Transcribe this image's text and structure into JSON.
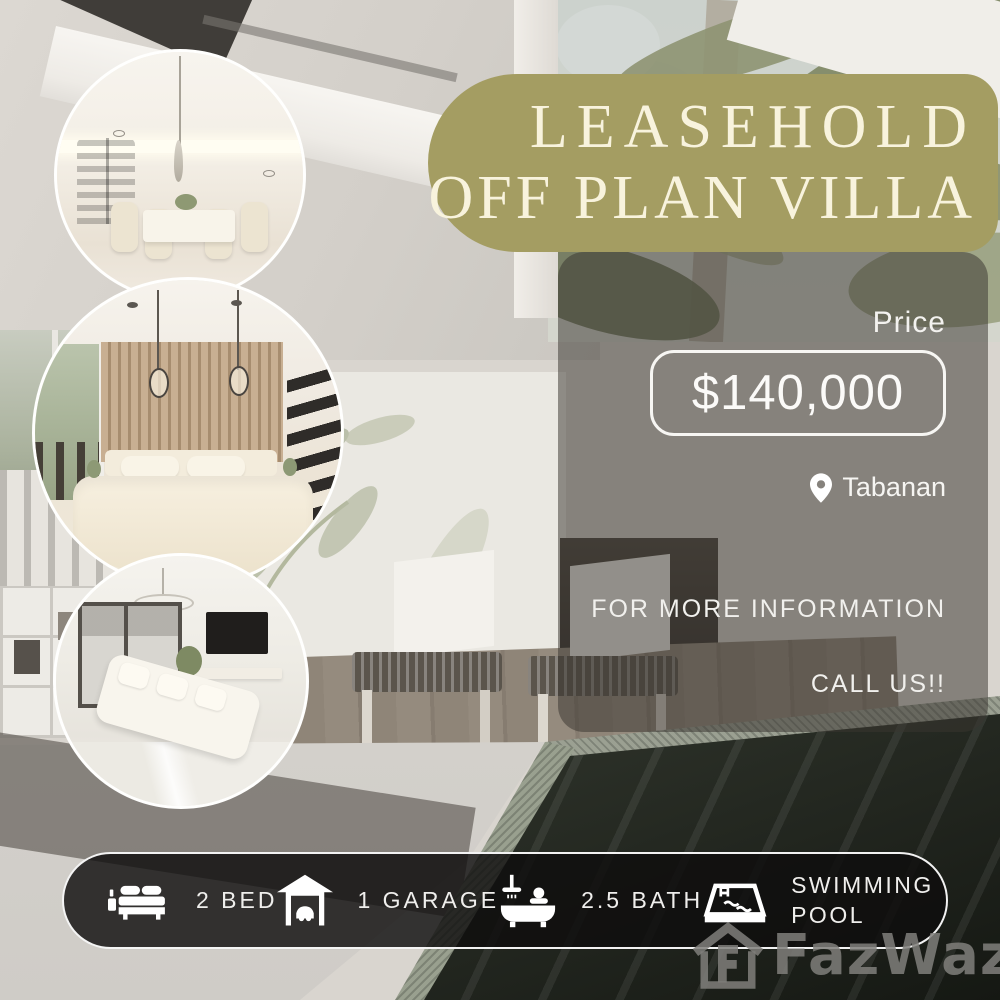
{
  "title_badge": {
    "line1": "LEASEHOLD",
    "line2": "OFF PLAN VILLA"
  },
  "price_panel": {
    "label": "Price",
    "value": "$140,000",
    "location": "Tabanan",
    "location_icon": "map-pin-icon",
    "info_line1": "FOR MORE INFORMATION",
    "info_line2": "CALL US!!"
  },
  "amenities": [
    {
      "icon": "bed-icon",
      "label": "2 BED"
    },
    {
      "icon": "garage-icon",
      "label": "1 GARAGE"
    },
    {
      "icon": "bath-icon",
      "label": "2.5 BATH"
    },
    {
      "icon": "pool-icon",
      "label": "SWIMMING POOL"
    }
  ],
  "watermark": {
    "brand": "FazWaz",
    "icon": "house-logo-icon"
  },
  "gallery": [
    {
      "name": "dining-room-photo"
    },
    {
      "name": "bedroom-photo"
    },
    {
      "name": "living-room-photo"
    }
  ],
  "colors": {
    "badge_olive": "#a49d62",
    "badge_text": "#f8f3dd",
    "overlay_gray": "rgba(58,54,47,0.52)",
    "bar_black": "rgba(15,14,13,0.82)",
    "text_white": "#f5f4f1"
  }
}
